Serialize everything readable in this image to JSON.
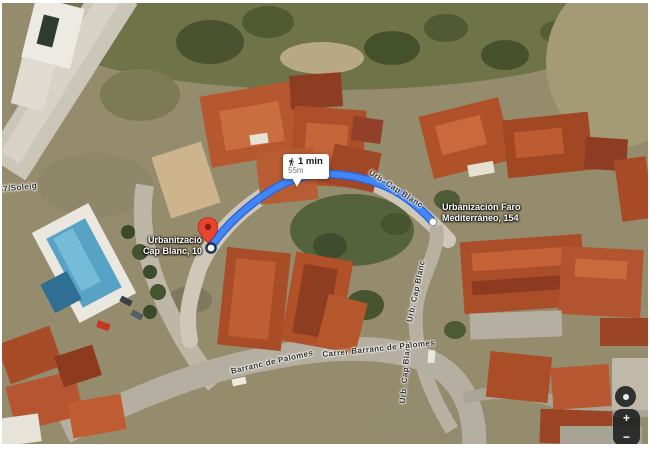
{
  "map": {
    "tooltip": {
      "duration": "1 min",
      "distance": "55m"
    },
    "destination_label": {
      "line1": "Urbanització",
      "line2": "Cap Blanc, 10"
    },
    "origin_place_label": {
      "line1": "Urbanización Faro",
      "line2": "Mediterráneo, 154"
    },
    "street_labels": {
      "route_road": "Urb. Cap Blanc",
      "right_road_upper": "Urb. Cap Blanc",
      "right_road_lower": "Urb. Cap Blanc",
      "bottom_left": "Barranc de Palomes",
      "bottom_right": "Carrer Barranc de Palomes",
      "left_edge": "37/Soleig"
    },
    "controls": {
      "zoom_in": "+",
      "zoom_out": "−"
    },
    "colors": {
      "route": "#4285F4",
      "route_casing": "#2A62D9",
      "pin_red": "#E8442E",
      "pool_blue": "#57A3C6"
    }
  }
}
